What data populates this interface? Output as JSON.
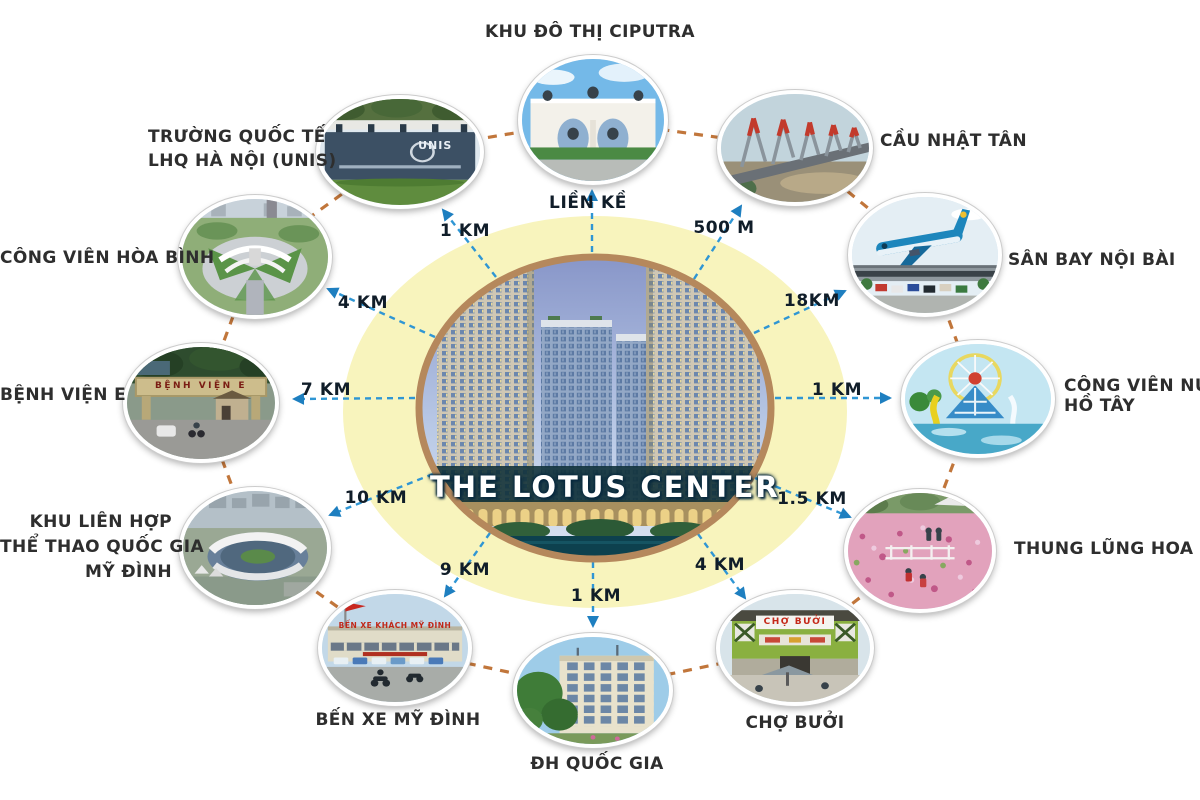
{
  "center": {
    "title": "THE LOTUS CENTER"
  },
  "colors": {
    "halo_yellow": "#f8f4bd",
    "arrow_blue": "#2f96d4",
    "ring_brown": "#c1763b",
    "building_ellipse_border": "#b5885c",
    "label_text": "#2e2e2e",
    "distance_text": "#101d29"
  },
  "locations": [
    {
      "id": "khu-do-thi-ciputra",
      "lines": [
        "KHU ĐÔ THỊ CIPUTRA"
      ],
      "distance": "LIỀN KỀ",
      "photo": "ciputra-gate-horse-statues",
      "photo_text": ""
    },
    {
      "id": "cau-nhat-tan",
      "lines": [
        "CẦU NHẬT TÂN"
      ],
      "distance": "500 M",
      "photo": "nhat-tan-cable-bridge",
      "photo_text": ""
    },
    {
      "id": "san-bay-noi-bai",
      "lines": [
        "SÂN BAY NỘI BÀI"
      ],
      "distance": "18KM",
      "photo": "noi-bai-airport-plane",
      "photo_text": ""
    },
    {
      "id": "cong-vien-nuoc-ho-tay",
      "lines": [
        "CÔNG VIÊN NƯỚC",
        "HỒ TÂY"
      ],
      "distance": "1 KM",
      "photo": "ho-tay-water-park-ferris-wheel",
      "photo_text": ""
    },
    {
      "id": "thung-lung-hoa",
      "lines": [
        "THUNG LŨNG HOA"
      ],
      "distance": "1.5 KM",
      "photo": "flower-valley-field",
      "photo_text": ""
    },
    {
      "id": "cho-buoi",
      "lines": [
        "CHỢ BƯỞI"
      ],
      "distance": "4 KM",
      "photo": "buoi-market-facade",
      "photo_text": "CHỢ BƯỞI"
    },
    {
      "id": "dh-quoc-gia",
      "lines": [
        "ĐH QUỐC GIA"
      ],
      "distance": "1 KM",
      "photo": "national-university-building",
      "photo_text": ""
    },
    {
      "id": "ben-xe-my-dinh",
      "lines": [
        "BẾN XE MỸ ĐÌNH"
      ],
      "distance": "9 KM",
      "photo": "my-dinh-bus-station",
      "photo_text": "BẾN XE KHÁCH MỸ ĐÌNH"
    },
    {
      "id": "khu-lien-hop-the-thao",
      "lines": [
        "KHU LIÊN HỢP",
        "THỂ THAO QUỐC GIA",
        "MỸ ĐÌNH"
      ],
      "distance": "10 KM",
      "photo": "my-dinh-national-stadium",
      "photo_text": ""
    },
    {
      "id": "benh-vien-e",
      "lines": [
        "BỆNH VIỆN E"
      ],
      "distance": "7 KM",
      "photo": "e-hospital-gate",
      "photo_text": "BỆNH VIỆN E"
    },
    {
      "id": "cong-vien-hoa-binh",
      "lines": [
        "CÔNG VIÊN HÒA BÌNH"
      ],
      "distance": "4 KM",
      "photo": "hoa-binh-park-monument",
      "photo_text": ""
    },
    {
      "id": "truong-quoc-te-unis",
      "lines": [
        "TRƯỜNG QUỐC TẾ",
        "LHQ HÀ NỘI (UNIS)"
      ],
      "distance": "1 KM",
      "photo": "unis-school-sign",
      "photo_text": "UNIS"
    }
  ]
}
